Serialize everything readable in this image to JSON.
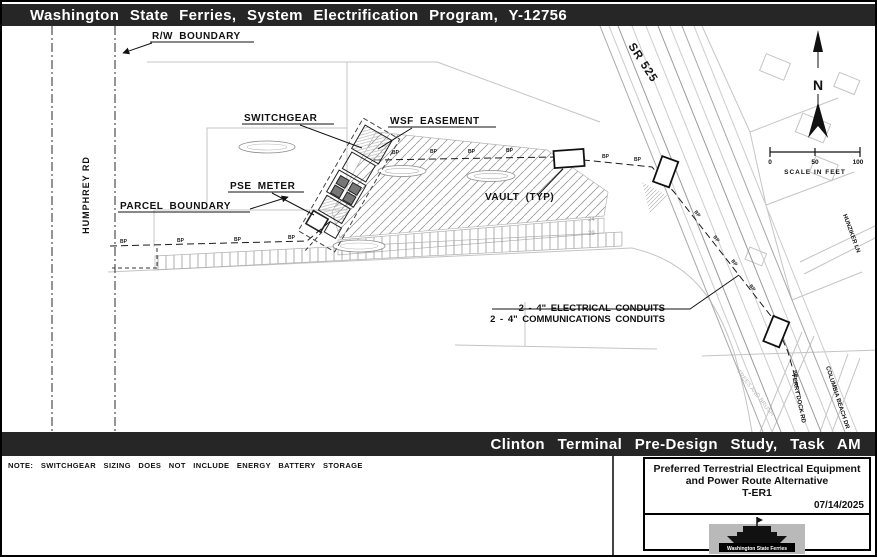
{
  "banner_top": {
    "title": "Washington State Ferries, System Electrification Program, Y-12756"
  },
  "banner_bottom": {
    "title": "Clinton Terminal Pre-Design Study, Task AM"
  },
  "note": "NOTE: SWITCHGEAR SIZING DOES NOT INCLUDE ENERGY BATTERY STORAGE",
  "title_block": {
    "title_line1": "Preferred Terrestrial Electrical Equipment",
    "title_line2": "and Power Route Alternative",
    "title_line3": "T-ER1",
    "date": "07/14/2025",
    "logo_text": "Washington State Ferries"
  },
  "plan": {
    "labels": {
      "rw_boundary": "R/W BOUNDARY",
      "humphrey_rd": "HUMPHREY RD",
      "switchgear": "SWITCHGEAR",
      "wsf_easement": "WSF EASEMENT",
      "pse_meter": "PSE METER",
      "parcel_boundary": "PARCEL BOUNDARY",
      "vault_typ": "VAULT (TYP)",
      "sr_525": "SR 525",
      "electrical_conduits": "2 - 4\" ELECTRICAL CONDUITS",
      "communications_conduits": "2 - 4\" COMMUNICATIONS CONDUITS",
      "hunziker_ln": "HUNZIKER LN",
      "ferry_dock_rd": "FERRY DOCK RD",
      "columbia_beach_dr": "COLUMBIA BEACH DR",
      "trees_and_brush": "TREES AND BRUSH",
      "bp_marker": "BP"
    },
    "north": "N",
    "scale": {
      "t0": "0",
      "t50": "50",
      "t100": "100",
      "caption": "SCALE IN FEET"
    },
    "stalls": {
      "row1": "24",
      "row2": "29"
    }
  },
  "colors": {
    "banner_bg": "#262626",
    "banner_fg": "#ffffff",
    "line_dark": "#1a1a1a",
    "line_gray": "#c4c4c4"
  }
}
